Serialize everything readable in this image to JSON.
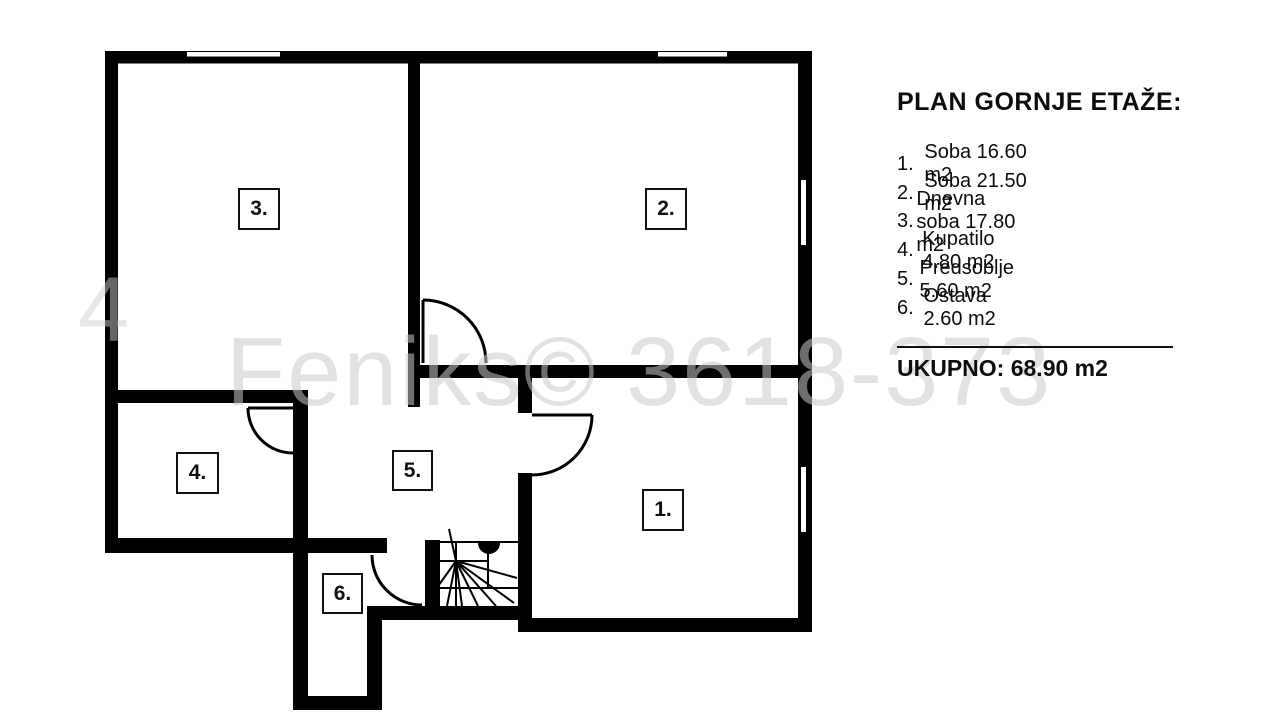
{
  "legend": {
    "title": "PLAN GORNJE ETAŽE:",
    "items": [
      {
        "number": "1.",
        "text": "Soba 16.60 m2"
      },
      {
        "number": "2.",
        "text": "Soba 21.50 m2"
      },
      {
        "number": "3.",
        "text": "Dnevna soba 17.80 m2"
      },
      {
        "number": "4.",
        "text": "Kupatilo 4.80 m2"
      },
      {
        "number": "5.",
        "text": "Predsoblje 5.60 m2"
      },
      {
        "number": "6.",
        "text": "Ostava 2.60 m2"
      }
    ],
    "total_label": "UKUPNO: 68.90 m2"
  },
  "plan": {
    "room_labels": [
      {
        "text": "1."
      },
      {
        "text": "2."
      },
      {
        "text": "3."
      },
      {
        "text": "4."
      },
      {
        "text": "5."
      },
      {
        "text": "6."
      }
    ],
    "colors": {
      "wall": "#000000",
      "background": "#ffffff",
      "watermark_grey": "#c8c8c8"
    }
  },
  "watermark": {
    "text": "Feniks© 3618-373",
    "left_fragment": "4"
  }
}
